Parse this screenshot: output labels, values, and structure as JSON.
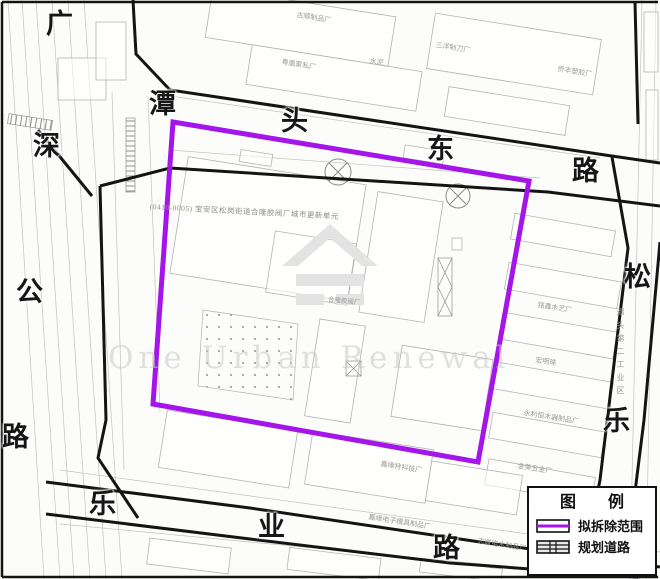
{
  "colors": {
    "demolition": "#A315E8",
    "road_line": "#141414"
  },
  "roads": {
    "guangshen_highway": {
      "chars": [
        "广",
        "深",
        "公",
        "路"
      ]
    },
    "tantou_east_road": {
      "chars": [
        "潭",
        "头",
        "东",
        "路"
      ]
    },
    "songle_road": {
      "chars": [
        "松",
        "乐"
      ]
    },
    "leye_road": {
      "chars": [
        "乐",
        "业",
        "路"
      ]
    }
  },
  "area": {
    "unit_label": "(0410-0005) 宝安区松岗街道合隆胶阀厂城市更新单元",
    "site_label": "合隆胶阀厂",
    "industrial_zone_label": "潭头第二工业区"
  },
  "factories": [
    "古顺制品厂",
    "粤凰家私厂",
    "水泥",
    "三洋制刀厂",
    "侨丰塑胶厂",
    "铭鑫木艺厂",
    "宏明珠",
    "永利恒木器制品厂",
    "金美五金厂",
    "嘉缘特科技厂",
    "嘉缘电子模具制品厂",
    "志联电木制品厂"
  ],
  "watermark": {
    "text": "One Urban Renewal"
  },
  "legend": {
    "title": "图 例",
    "items": [
      {
        "label": "拟拆除范围"
      },
      {
        "label": "规划道路"
      }
    ]
  }
}
